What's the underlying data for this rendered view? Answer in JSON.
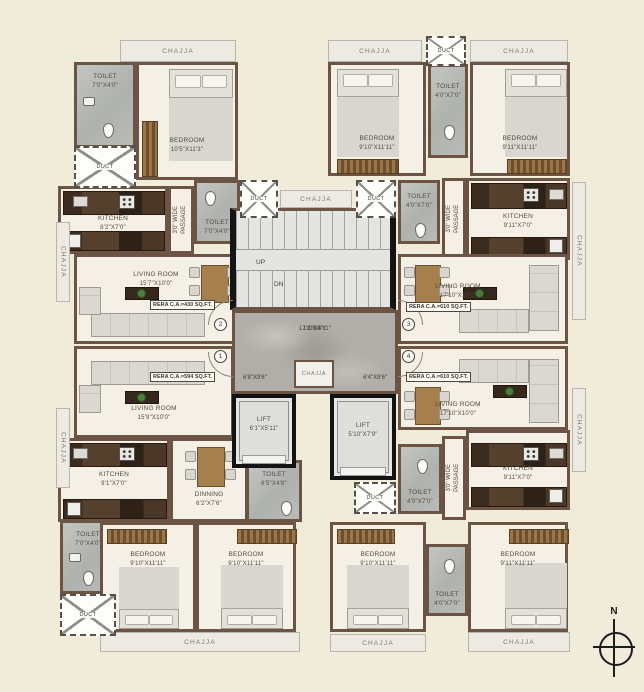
{
  "common": {
    "chajja": "CHAJJA",
    "duct": "DUCT",
    "toilet": "TOILET",
    "bedroom": "BEDROOM",
    "kitchen": "KITCHEN",
    "living_room": "LIVING ROOM",
    "dinning": "DINNING",
    "passage": "3'0\" WIDE PASSAGE",
    "lift": "LIFT",
    "lobby": "LOBBY",
    "up": "UP",
    "dn": "DN",
    "north": "N"
  },
  "core": {
    "lobby_dim": "17'3\"X4'11\"",
    "lobby_left_dim": "6'8\"X9'6\"",
    "lobby_right_dim": "6'4\"X9'6\"",
    "lift_left_dim": "6'1\"X5'11\"",
    "lift_right_dim": "5'10\"X7'9\""
  },
  "units": {
    "top_left": {
      "door_no": "2",
      "rera": "RERA C.A.=430 SQ.FT.",
      "toilet_top_dim": "7'0\"X4'0\"",
      "bedroom_dim": "10'5\"X11'3\"",
      "kitchen_dim": "8'2\"X7'0\"",
      "toilet_passage_dim": "7'0\"X4'0\"",
      "living_dim": "15'7\"X10'0\""
    },
    "top_right": {
      "door_no": "3",
      "rera": "RERA C.A.=610 SQ.FT.",
      "bedroom1_dim": "9'10\"X11'11\"",
      "toilet_top_dim": "4'0\"X7'0\"",
      "bedroom2_dim": "9'11\"X11'11\"",
      "toilet_passage_dim": "4'0\"X7'0\"",
      "kitchen_dim": "9'11\"X7'0\"",
      "living_dim": "17'10\"X10'0\""
    },
    "bottom_left": {
      "door_no": "1",
      "rera": "RERA C.A.=594 SQ.FT.",
      "living_dim": "15'9\"X10'0\"",
      "kitchen_dim": "9'1\"X7'0\"",
      "dinning_dim": "6'2\"X7'6\"",
      "toilet_lift_dim": "6'5\"X4'8\"",
      "toilet_corner_dim": "7'0\"X4'0\"",
      "bedroom1_dim": "9'10\"X11'11\"",
      "bedroom2_dim": "9'10\"X11'11\""
    },
    "bottom_right": {
      "door_no": "4",
      "rera": "RERA C.A.=610 SQ.FT.",
      "living_dim": "17'10\"X10'0\"",
      "kitchen_dim": "9'11\"X7'0\"",
      "toilet_lift_dim": "4'0\"X7'0\"",
      "toilet_mid_dim": "4'0\"X7'0\"",
      "bedroom1_dim": "9'10\"X11'11\"",
      "bedroom2_dim": "9'11\"X11'11\""
    }
  },
  "colors": {
    "background": "#f0ecd9",
    "wall": "#6b5443",
    "floor": "#f4f0e5",
    "toilet_floor": "#b9bbb8",
    "lobby_floor": "#b1aea9",
    "accent_black": "#141414"
  }
}
